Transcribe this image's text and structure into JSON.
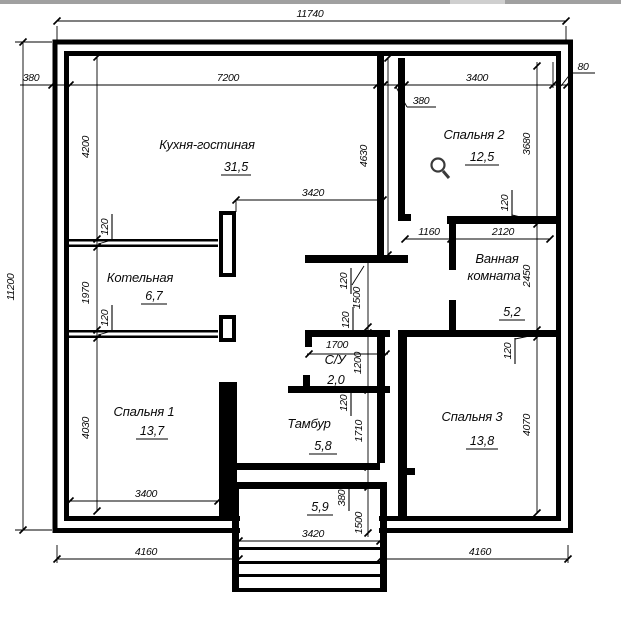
{
  "colors": {
    "background": "#ffffff",
    "line": "#000000",
    "top_strip": "#a0a0a0",
    "top_strip_tab": "#cfcfcf",
    "cursor": "#3a3a3a"
  },
  "rooms": {
    "kitchen": {
      "name": "Кухня-гостиная",
      "area": "31,5"
    },
    "boiler": {
      "name": "Котельная",
      "area": "6,7"
    },
    "bedroom1": {
      "name": "Спальня 1",
      "area": "13,7"
    },
    "bedroom2": {
      "name": "Спальня 2",
      "area": "12,5"
    },
    "bedroom3": {
      "name": "Спальня 3",
      "area": "13,8"
    },
    "bathroom": {
      "name_line1": "Ванная",
      "name_line2": "комната",
      "area": "5,2"
    },
    "wc": {
      "name": "С/У",
      "area": "2,0"
    },
    "tambour": {
      "name": "Тамбур",
      "area": "5,8"
    },
    "porch": {
      "area": "5,9"
    }
  },
  "dims": {
    "total_width": "11740",
    "total_height": "11200",
    "wall_left": "380",
    "kitchen_width": "7200",
    "bedroom2_width": "3400",
    "wall_right": "80",
    "wall_mid": "380",
    "kitchen_height": "4200",
    "wall_p1": "120",
    "boiler_height": "1970",
    "wall_p2": "120",
    "bedroom1_height": "4030",
    "kitchen_pass": "3420",
    "kitchen_right_height": "4630",
    "hall_wall_top": "120",
    "hall_width": "1500",
    "hall_wall_bottom": "120",
    "wc_width": "1700",
    "wc_height": "1200",
    "wc_wall": "120",
    "tambour_height": "1710",
    "porch_wall": "380",
    "porch_height": "1500",
    "porch_width": "3420",
    "bottom_left": "4160",
    "bottom_right": "4160",
    "bedroom1_width": "3400",
    "bath_pass": "1160",
    "bath_width": "2120",
    "bath_wall_top": "120",
    "bath_height": "2450",
    "bath_wall_bottom": "120",
    "bedroom2_height": "3680",
    "bedroom3_height": "4070"
  }
}
